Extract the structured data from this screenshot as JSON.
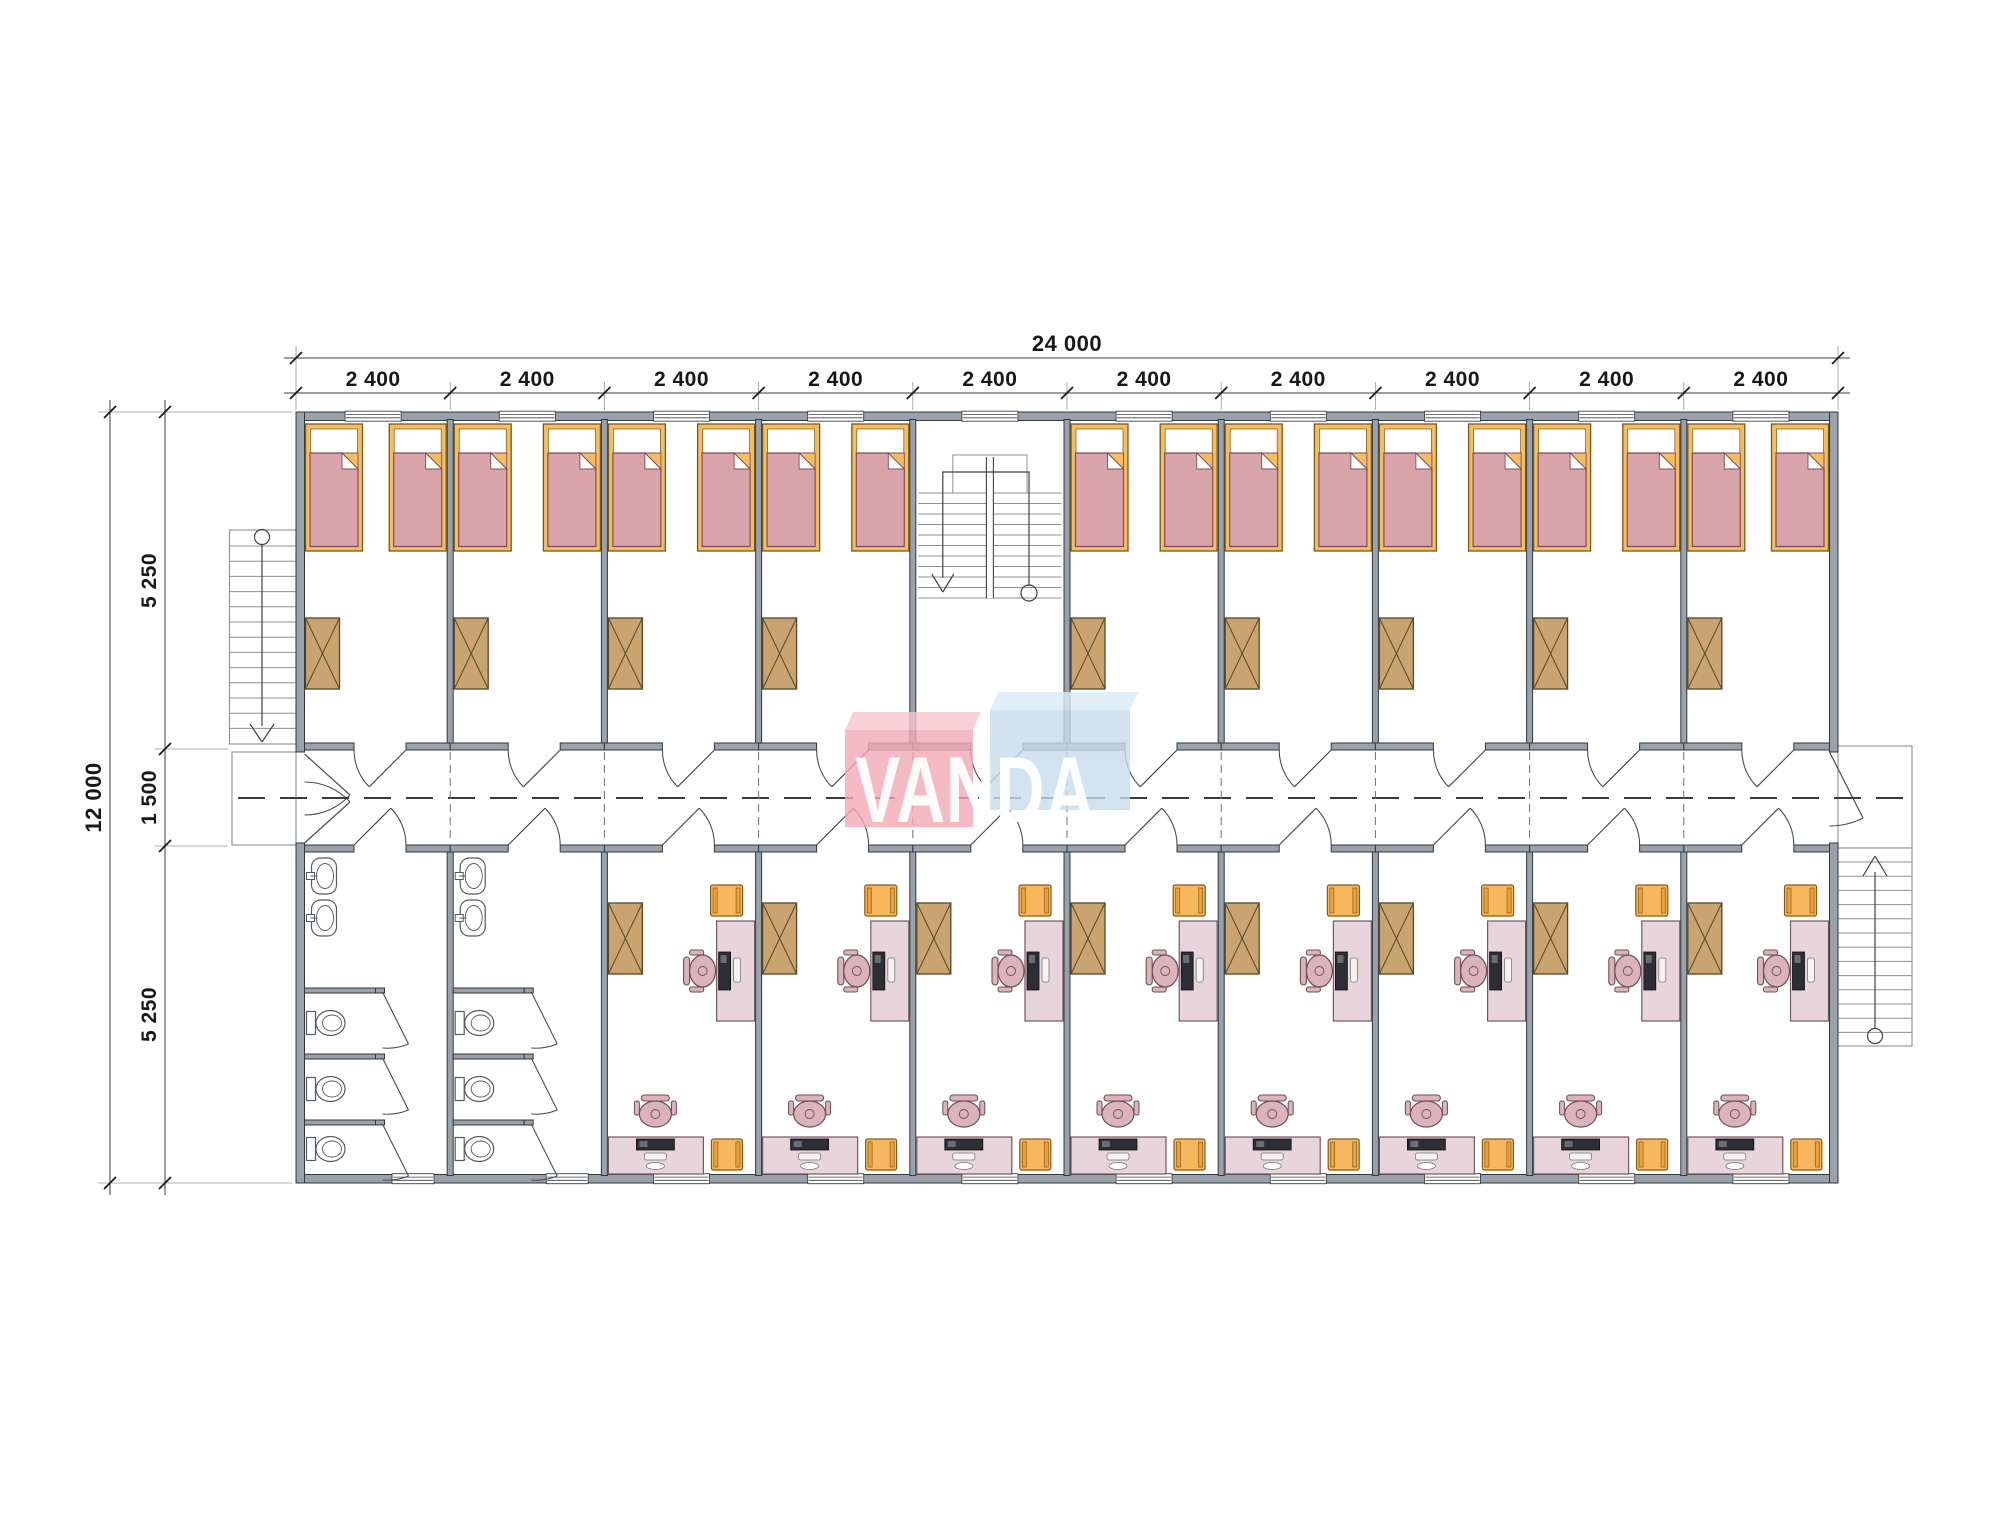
{
  "dimensions": {
    "overall_width": "24 000",
    "bay_width": "2 400",
    "bay_count": 10,
    "overall_depth": "12 000",
    "top_room_depth": "5 250",
    "corridor_depth": "1 500",
    "bottom_room_depth": "5 250"
  },
  "logo": {
    "text": "VANDA"
  },
  "plan": {
    "top_modules": [
      "bedroom",
      "bedroom",
      "bedroom",
      "bedroom",
      "stairwell",
      "bedroom",
      "bedroom",
      "bedroom",
      "bedroom",
      "bedroom"
    ],
    "bottom_modules": [
      "bathroom",
      "bathroom",
      "study",
      "study",
      "study",
      "study",
      "study",
      "study",
      "study",
      "study"
    ],
    "bedroom": {
      "beds": 2,
      "wardrobes": 1
    },
    "study": {
      "desks": 2,
      "chairs": 2,
      "stools": 2,
      "wardrobes": 1
    },
    "bathroom": {
      "sinks": 2,
      "toilets": 3,
      "stalls": 3
    },
    "exterior": {
      "stairs": 2,
      "landings": 2,
      "internal_stairwells": 1
    }
  },
  "colors": {
    "wall_fill": "#99a1aa",
    "wall_stroke": "#33383e",
    "thin": "#8a9096",
    "line": "#3f4347",
    "bed_frame": "#f4bd63",
    "bed_frame_stroke": "#77591d",
    "blanket": "#d9a3aa",
    "blanket_stroke": "#7e4e58",
    "wardrobe": "#c9a471",
    "wardrobe_stroke": "#564828",
    "desk": "#e8d5dc",
    "desk_stroke": "#70595f",
    "chair": "#dab3bb",
    "chair_stroke": "#6e4e57",
    "stool": "#f7b75f",
    "stool_stroke": "#8a5a16",
    "fixture_stroke": "#565b61",
    "monitor": "#2c2e33",
    "door": "#4a4e53",
    "axis": "#3a3a3a",
    "dim_line": "#3c3c3c",
    "logo_pink": "#f2a9b5",
    "logo_pink_top": "#f7c6cd",
    "logo_blue": "#c7dcee",
    "logo_blue_top": "#dcebf7"
  }
}
